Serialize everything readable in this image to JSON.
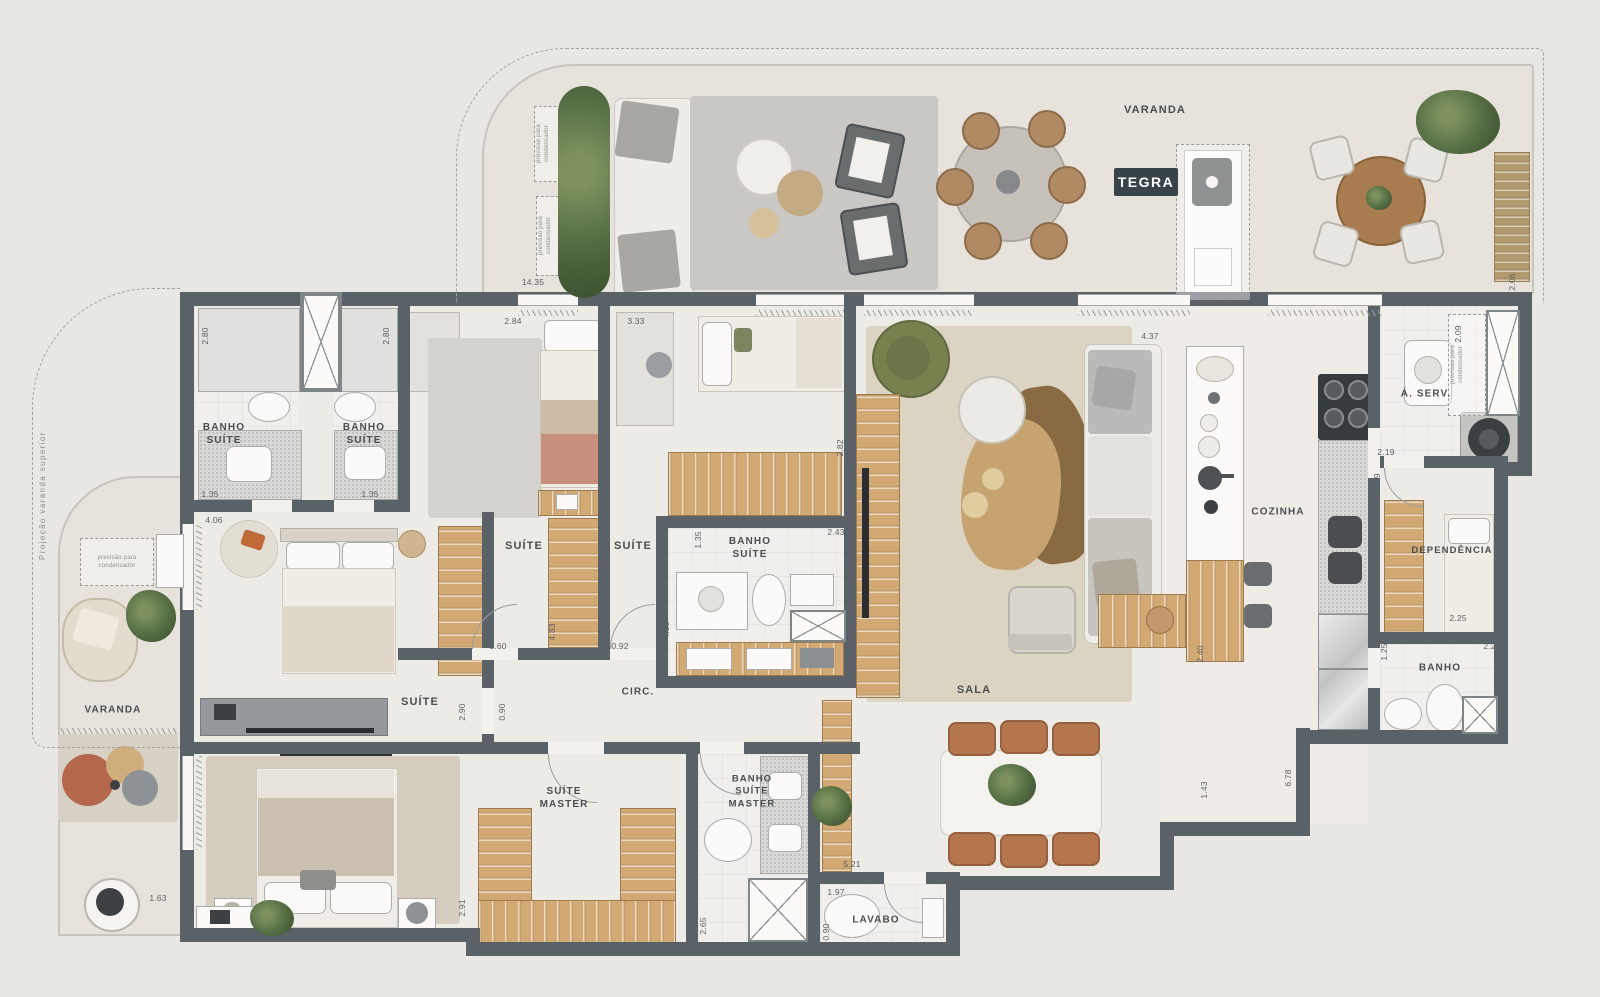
{
  "brand": {
    "logo": "TEGRA"
  },
  "labels": {
    "varanda_top": "VARANDA",
    "banho_suite_1": "BANHO\nSUÍTE",
    "banho_suite_2": "BANHO\nSUÍTE",
    "suite_top_left": "SUÍTE",
    "suite_top_right": "SUÍTE",
    "banho_suite_3": "BANHO\nSUÍTE",
    "cozinha": "COZINHA",
    "area_servico": "Á. SERV.",
    "dependencia": "DEPENDÊNCIA",
    "banho": "BANHO",
    "varanda_left": "VARANDA",
    "suite_1": "SUÍTE",
    "circulacao": "CIRC.",
    "sala": "SALA",
    "suite_master": "SUÍTE\nMASTER",
    "banho_suite_master": "BANHO\nSUÍTE\nMASTER",
    "lavabo": "LAVABO"
  },
  "annotations": {
    "projection": "Projeção varanda superior",
    "provision": "previsão para\ncondensador"
  },
  "dims": {
    "d01": "14.35",
    "d02": "2.84",
    "d03": "3.33",
    "d04": "2.80",
    "d05": "2.80",
    "d06": "1.35",
    "d07": "1.35",
    "d08": "2.83",
    "d09": "4.06",
    "d10": "1.60",
    "d11": "4.83",
    "d12": "0.92",
    "d13": "4.83",
    "d14": "1.35",
    "d15": "2.43",
    "d16": "2.82",
    "d17": "4.37",
    "d18": "2.40",
    "d19": "2.06",
    "d20": "2.09",
    "d21": "2.19",
    "d22": "2.09",
    "d23": "2.25",
    "d24": "2.22",
    "d25": "1.25",
    "d26": "6.78",
    "d27": "1.43",
    "d28": "7.93",
    "d29": "2.90",
    "d30": "0.90",
    "d31": "6.53",
    "d32": "1.99",
    "d33": "2.91",
    "d34": "2.65",
    "d35": "5.21",
    "d36": "1.97",
    "d37": "0.90",
    "d38": "1.63"
  },
  "colors": {
    "wall": "#5a6268",
    "wood": "#d2a873",
    "balcony_floor": "#e7e3dc",
    "indoor_floor": "#edebe6",
    "rug_beige": "#dcd4c3",
    "accent_terracotta": "#b4674a",
    "plant_green": "#5c744a"
  }
}
